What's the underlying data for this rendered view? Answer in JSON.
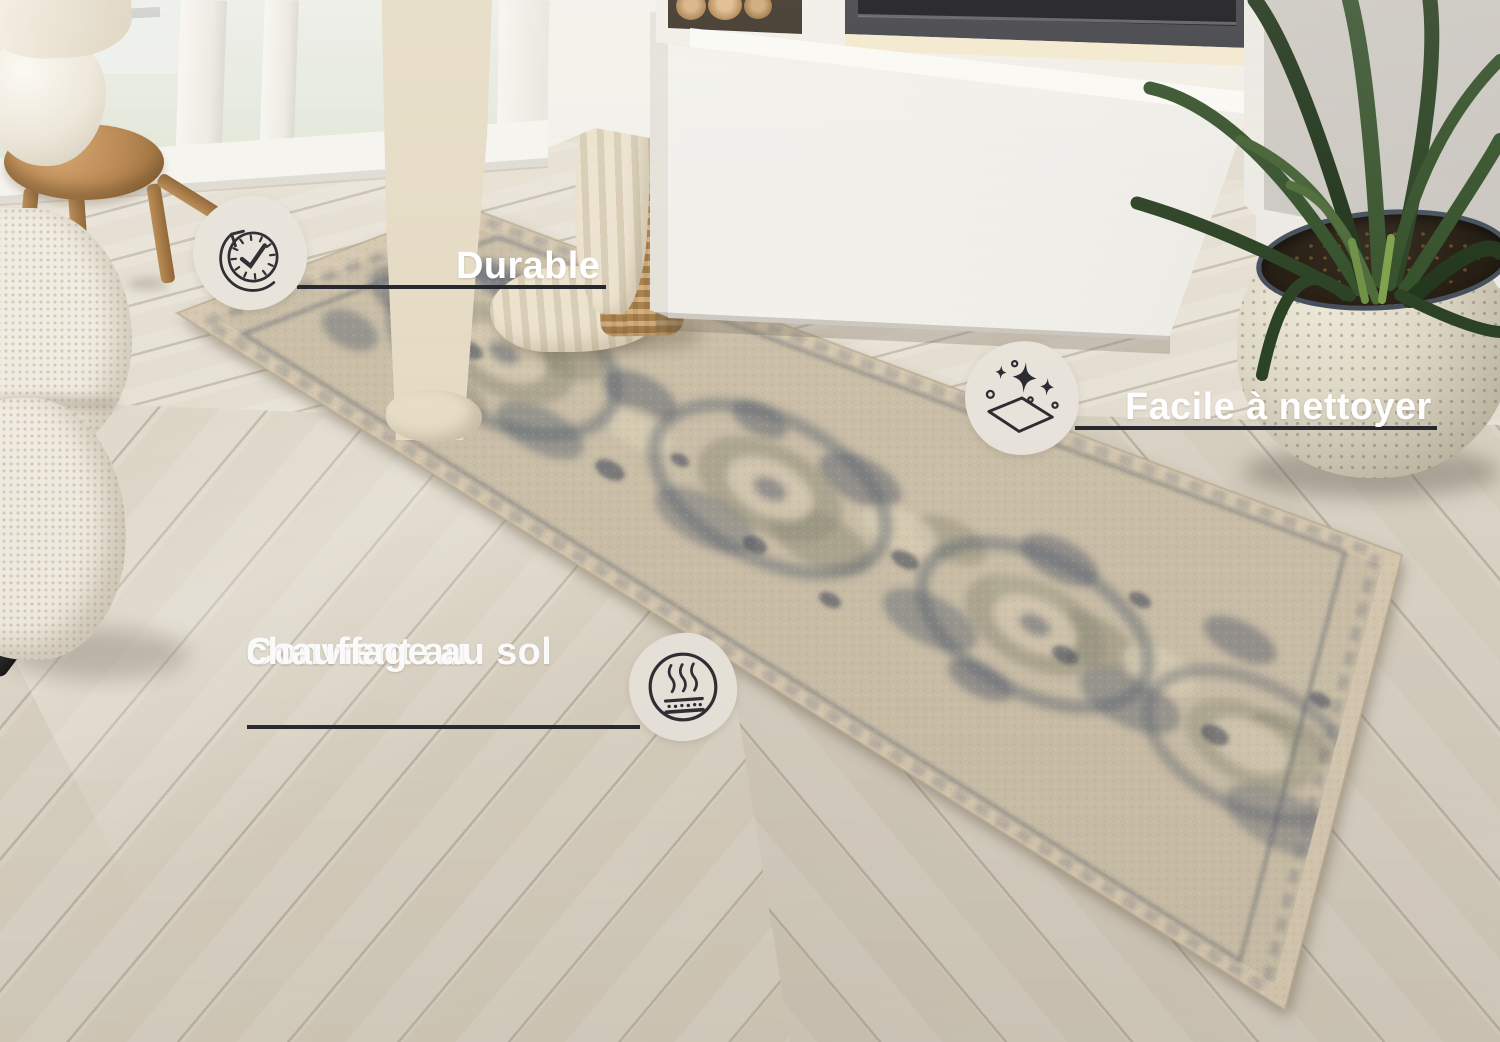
{
  "features": [
    {
      "label": "Durable",
      "icon": "clock-durability-icon"
    },
    {
      "label": "Facile à nettoyer",
      "icon": "sparkles-easy-clean-icon"
    },
    {
      "label_line1": "Convient au",
      "label_line2": "chauffage au sol",
      "icon": "floor-heating-icon"
    }
  ],
  "colors": {
    "label_text": "#ffffff",
    "underline": "#26262e",
    "badge_background": "#e8e4db",
    "icon_stroke": "#2d2c32",
    "rug_base": "#cbbfa8",
    "rug_pattern": "#5c6472"
  }
}
